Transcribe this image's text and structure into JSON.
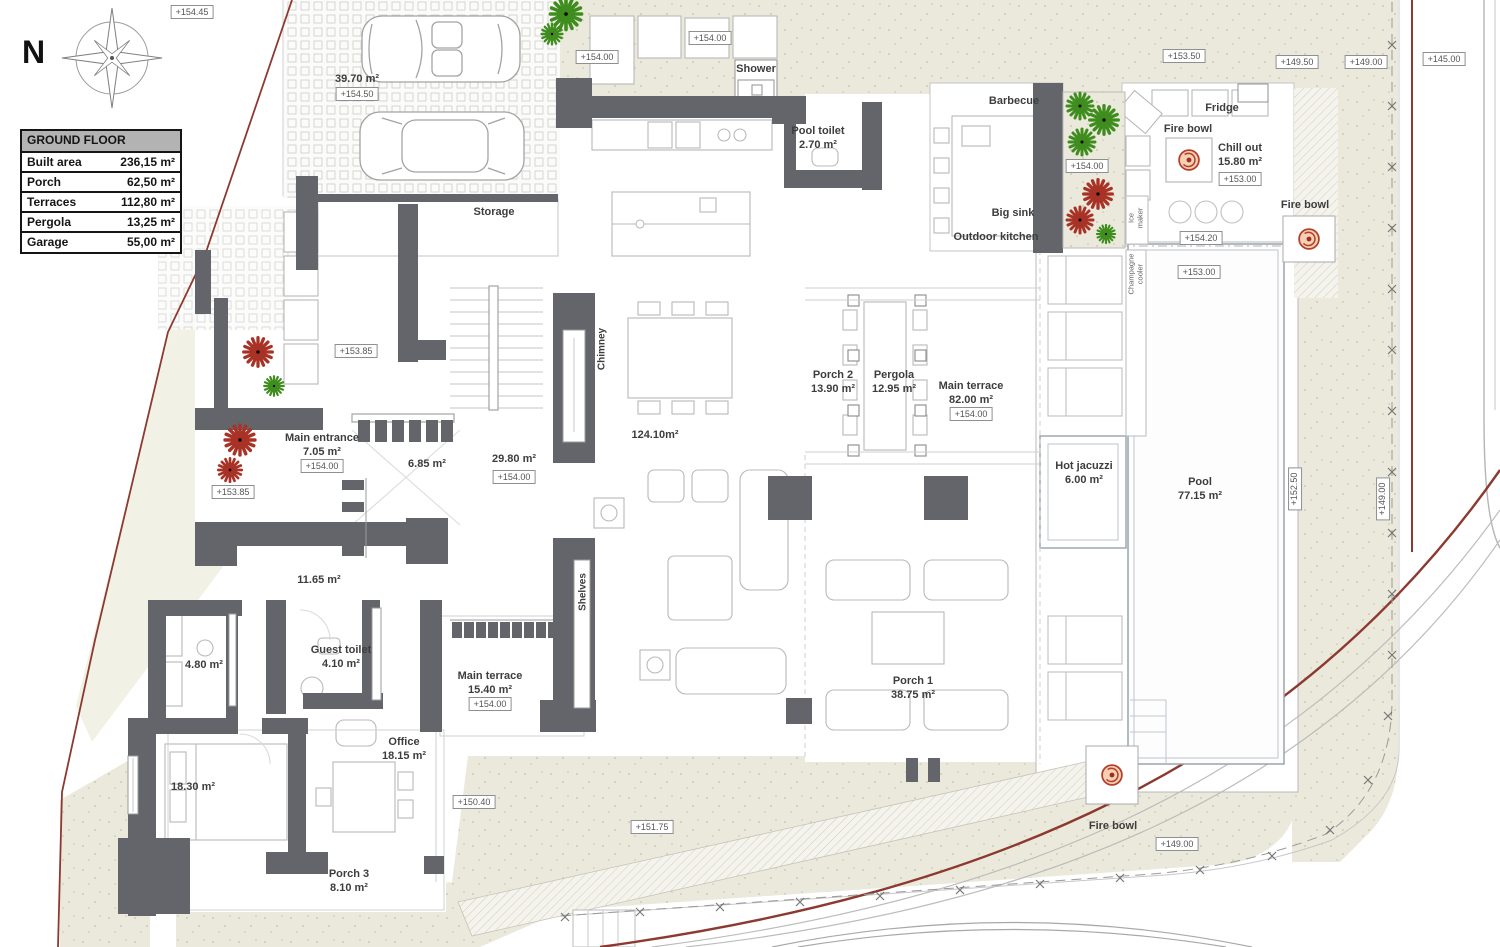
{
  "plan": {
    "table": {
      "header": "GROUND FLOOR",
      "rows": [
        {
          "label": "Built area",
          "value": "236,15 m²"
        },
        {
          "label": "Porch",
          "value": "62,50 m²"
        },
        {
          "label": "Terraces",
          "value": "112,80 m²"
        },
        {
          "label": "Pergola",
          "value": "13,25 m²"
        },
        {
          "label": "Garage",
          "value": "55,00 m²"
        }
      ]
    },
    "compass": {
      "north": "N"
    },
    "colors": {
      "wall": "#63656a",
      "boundary_red": "#8c3a30",
      "terrain": "#eae9db",
      "plant_green": "#3f8d1e",
      "plant_red": "#a93226",
      "fire_bowl": "#b4402c"
    },
    "labels": [
      {
        "id": "elev-154-45",
        "text": "+154.45"
      },
      {
        "id": "garage-area",
        "text": "39.70 m²"
      },
      {
        "id": "elev-154-50",
        "text": "+154.50"
      },
      {
        "id": "storage",
        "text": "Storage"
      },
      {
        "id": "elev-154-00-kitchen",
        "text": "+154.00"
      },
      {
        "id": "elev-154-00-top",
        "text": "+154.00"
      },
      {
        "id": "shower",
        "text": "Shower"
      },
      {
        "id": "pool-toilet",
        "text": "Pool toilet\n2.70 m²"
      },
      {
        "id": "barbecue",
        "text": "Barbecue"
      },
      {
        "id": "fridge",
        "text": "Fridge"
      },
      {
        "id": "fire-bowl-chillout",
        "text": "Fire bowl"
      },
      {
        "id": "chill-out",
        "text": "Chill out\n15.80 m²"
      },
      {
        "id": "elev-153-00-chillout",
        "text": "+153.00"
      },
      {
        "id": "elev-154-00-planter",
        "text": "+154.00"
      },
      {
        "id": "big-sink",
        "text": "Big sink"
      },
      {
        "id": "outdoor-kitchen",
        "text": "Outdoor kitchen"
      },
      {
        "id": "elev-154-20",
        "text": "+154.20"
      },
      {
        "id": "ice-maker",
        "text": "Ice\nmaker"
      },
      {
        "id": "champagne-cooler",
        "text": "Champagne\ncooler"
      },
      {
        "id": "elev-153-00-pool",
        "text": "+153.00"
      },
      {
        "id": "elev-153-50",
        "text": "+153.50"
      },
      {
        "id": "elev-149-50",
        "text": "+149.50"
      },
      {
        "id": "elev-149-00-top",
        "text": "+149.00"
      },
      {
        "id": "elev-145-00",
        "text": "+145.00"
      },
      {
        "id": "fire-bowl-right",
        "text": "Fire bowl"
      },
      {
        "id": "porch-2",
        "text": "Porch 2\n13.90 m²"
      },
      {
        "id": "pergola",
        "text": "Pergola\n12.95 m²"
      },
      {
        "id": "main-terrace-82",
        "text": "Main terrace\n82.00 m²"
      },
      {
        "id": "elev-154-00-terrace",
        "text": "+154.00"
      },
      {
        "id": "living-area",
        "text": "124.10m²"
      },
      {
        "id": "main-entrance",
        "text": "Main entrance\n7.05 m²"
      },
      {
        "id": "elev-154-00-entrance",
        "text": "+154.00"
      },
      {
        "id": "hall-6-85",
        "text": "6.85 m²"
      },
      {
        "id": "corridor-29-80",
        "text": "29.80 m²"
      },
      {
        "id": "elev-154-00-corridor",
        "text": "+154.00"
      },
      {
        "id": "elev-153-85-upper",
        "text": "+153.85"
      },
      {
        "id": "elev-153-85-lower",
        "text": "+153.85"
      },
      {
        "id": "chimney",
        "text": "Chimney"
      },
      {
        "id": "shelves",
        "text": "Shelves"
      },
      {
        "id": "hot-jacuzzi",
        "text": "Hot jacuzzi\n6.00 m²"
      },
      {
        "id": "pool",
        "text": "Pool\n77.15 m²"
      },
      {
        "id": "elev-152-50",
        "text": "+152.50"
      },
      {
        "id": "elev-149-00-side",
        "text": "+149.00"
      },
      {
        "id": "hall-11-65",
        "text": "11.65 m²"
      },
      {
        "id": "bath-4-80",
        "text": "4.80 m²"
      },
      {
        "id": "guest-toilet",
        "text": "Guest toilet\n4.10 m²"
      },
      {
        "id": "bedroom-18-30",
        "text": "18.30 m²"
      },
      {
        "id": "office",
        "text": "Office\n18.15 m²"
      },
      {
        "id": "porch-3",
        "text": "Porch 3\n8.10 m²"
      },
      {
        "id": "main-terrace-15",
        "text": "Main terrace\n15.40 m²"
      },
      {
        "id": "elev-154-00-terrace2",
        "text": "+154.00"
      },
      {
        "id": "elev-150-40",
        "text": "+150.40"
      },
      {
        "id": "elev-151-75",
        "text": "+151.75"
      },
      {
        "id": "porch-1",
        "text": "Porch 1\n38.75 m²"
      },
      {
        "id": "fire-bowl-bottom",
        "text": "Fire bowl"
      },
      {
        "id": "elev-149-00-bottom",
        "text": "+149.00"
      }
    ]
  }
}
